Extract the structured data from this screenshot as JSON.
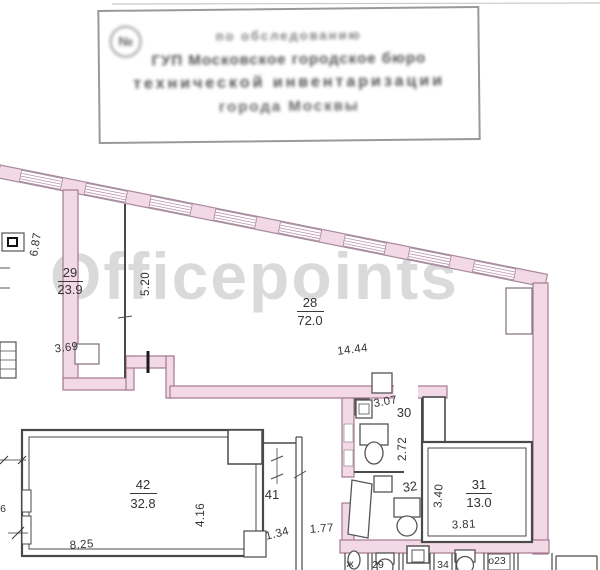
{
  "watermark": {
    "text": "Officepoints",
    "color": "#d7d7d7"
  },
  "stamp": {
    "symbol": "№",
    "lines": {
      "l1": "по обследованию",
      "l2": "ГУП Московское городское бюро",
      "l3": "технической инвентаризации",
      "l4": "города Москвы"
    }
  },
  "rooms": [
    {
      "number": "29",
      "area": "23.9"
    },
    {
      "number": "28",
      "area": "72.0"
    },
    {
      "number": "42",
      "area": "32.8"
    },
    {
      "number": "41",
      "area": ""
    },
    {
      "number": "30",
      "area": ""
    },
    {
      "number": "32",
      "area": ""
    },
    {
      "number": "31",
      "area": "13.0"
    }
  ],
  "dims": {
    "d687": "6.87",
    "d520": "5.20",
    "d369": "3.69",
    "d1444": "14.44",
    "d825": "8.25",
    "d416": "4.16",
    "d134": "1.34",
    "d177": "1.77",
    "d307": "3.07",
    "d272": "2.72",
    "d340": "3.40",
    "d381": "3.81"
  },
  "partials": {
    "p1": "ж",
    "p2": "29",
    "p3": "34",
    "p4": "о23",
    "p5": "6"
  },
  "colors": {
    "wall_pink_fill": "#f3d9e6",
    "wall_pink_stroke": "#a6798f",
    "wall_gray": "#4a4a4a",
    "watermark_gray": "#d7d7d7"
  }
}
